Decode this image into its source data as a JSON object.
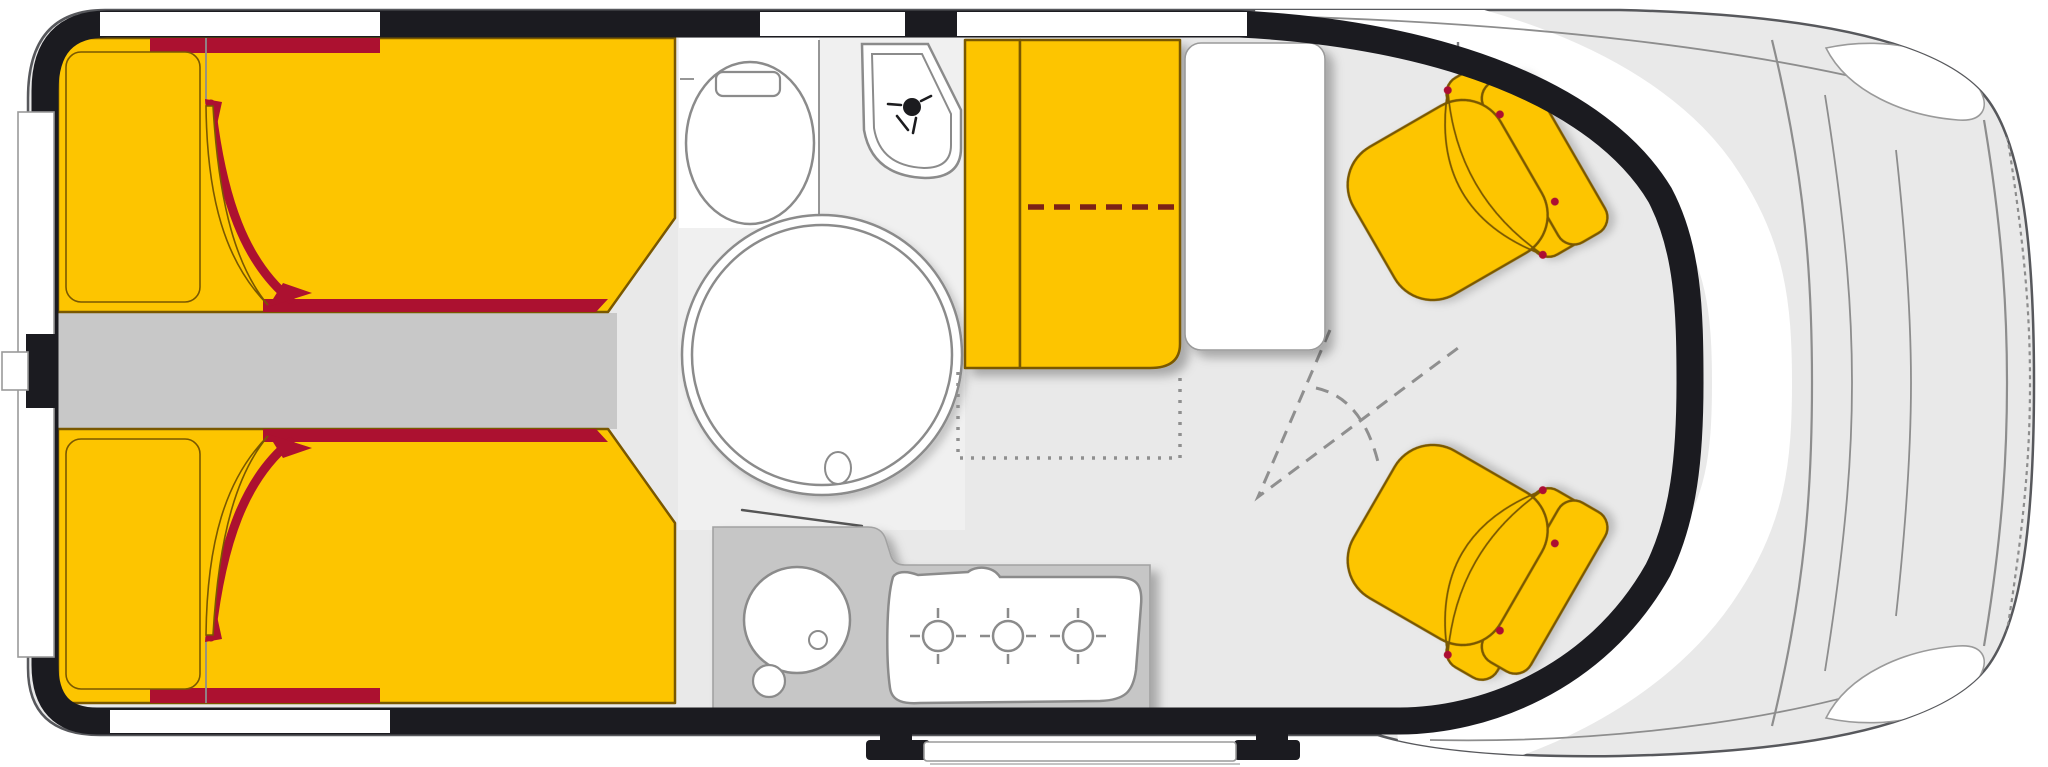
{
  "title": "Campervan floor plan, top view: rear twin beds, washroom with round shower, kitchen block, dinette with table and two swivelled cab seats",
  "colors": {
    "wall": "#1b1b20",
    "body_outline": "#57585c",
    "floor": "#e9e9e9",
    "aisle_floor": "#c8c8c8",
    "bathroom_floor": "#f0f0f0",
    "furniture_yellow": "#fdc500",
    "furniture_outline": "#7a5800",
    "accent_red": "#ac1130",
    "dash_red": "#7b2013",
    "counter_gray": "#c6c6c6",
    "fixture_white": "#ffffff",
    "fixture_outline": "#8b8b8b",
    "guide_gray": "#8f8f8f"
  },
  "areas": [
    {
      "id": "rear-doors",
      "label": "rear doors"
    },
    {
      "id": "rear-bed-top",
      "label": "rear single bed (upper)"
    },
    {
      "id": "rear-bed-bottom",
      "label": "rear single bed (lower)"
    },
    {
      "id": "center-aisle",
      "label": "aisle between beds"
    },
    {
      "id": "washroom",
      "label": "washroom"
    },
    {
      "id": "toilet",
      "label": "toilet"
    },
    {
      "id": "shower-basin",
      "label": "corner basin with hand shower"
    },
    {
      "id": "shower-cabin",
      "label": "round shower cabin"
    },
    {
      "id": "kitchen-counter",
      "label": "kitchen block"
    },
    {
      "id": "kitchen-sink",
      "label": "round sink"
    },
    {
      "id": "stove",
      "label": "3-burner hob"
    },
    {
      "id": "dinette-bench",
      "label": "dinette bench seat"
    },
    {
      "id": "dinette-table",
      "label": "table"
    },
    {
      "id": "bed-extension-zone",
      "label": "dotted conversion zone"
    },
    {
      "id": "swivel-seat-top",
      "label": "swivelled cab seat (driver side)"
    },
    {
      "id": "swivel-seat-bottom",
      "label": "swivelled cab seat (passenger side)"
    },
    {
      "id": "cab-front",
      "label": "driver cab / hood"
    },
    {
      "id": "entry-step",
      "label": "sliding-door entry step"
    }
  ]
}
